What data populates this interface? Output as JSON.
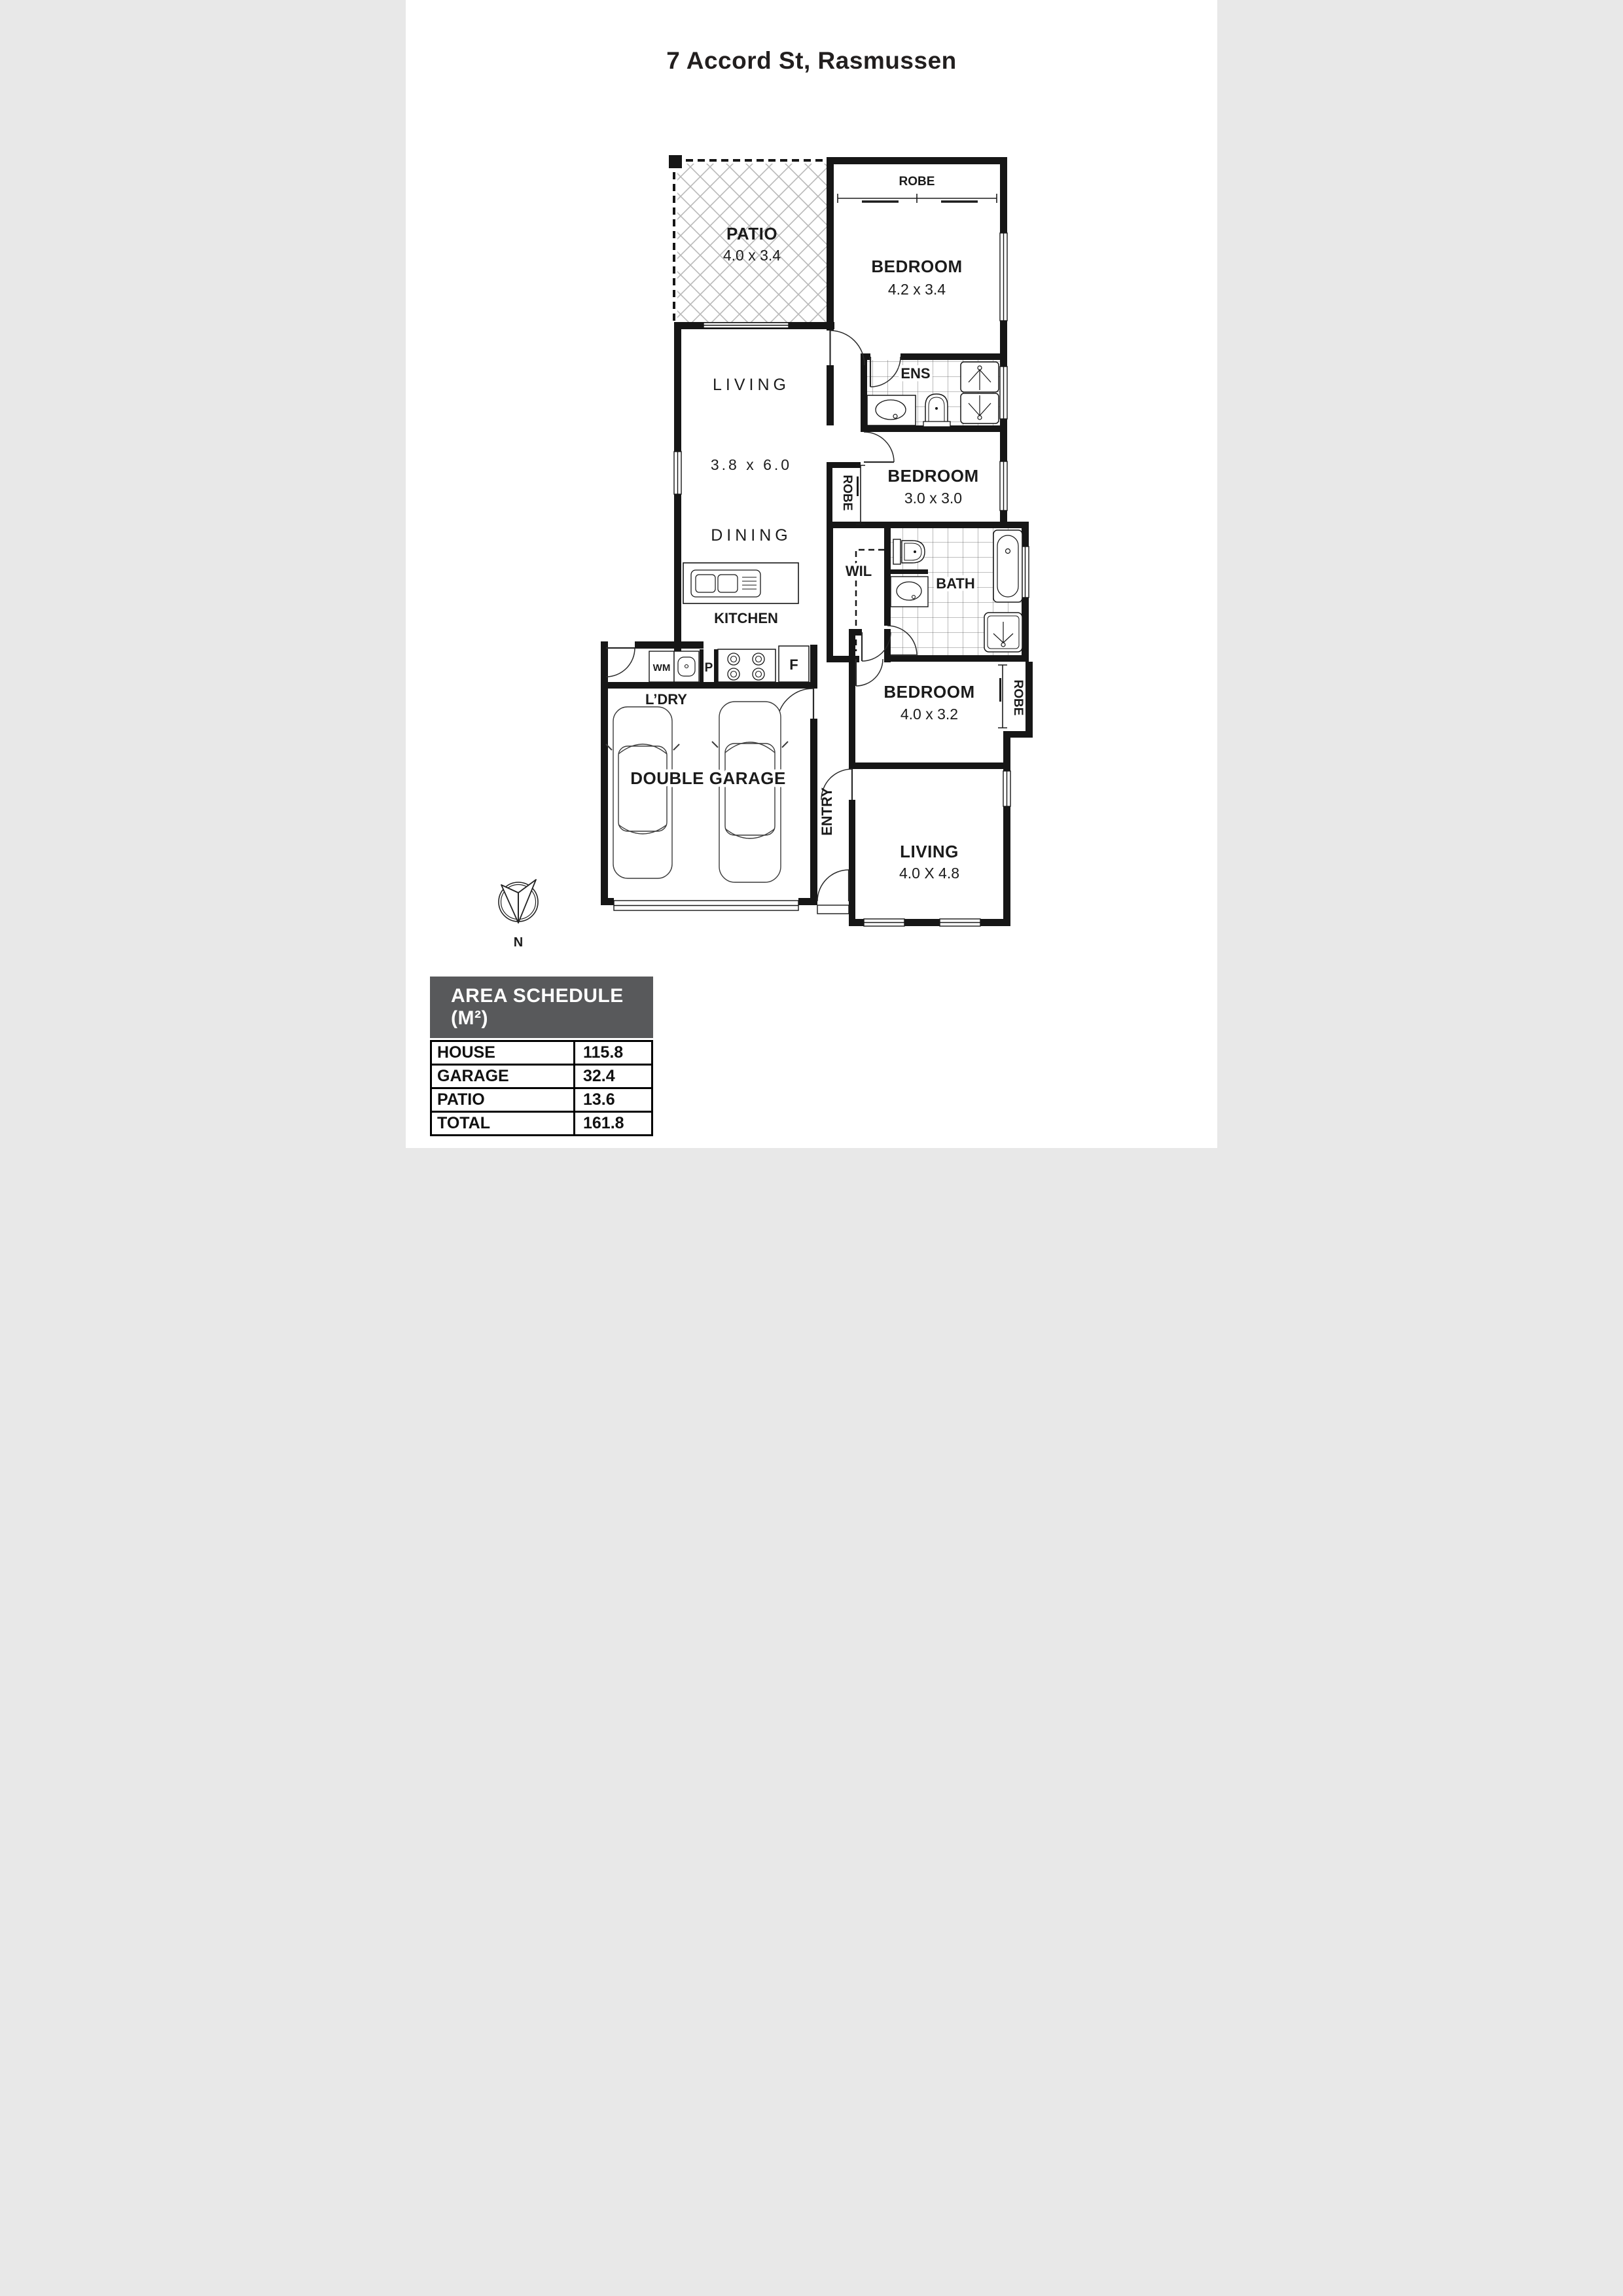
{
  "title": "7 Accord St, Rasmussen",
  "plan": {
    "rooms": {
      "patio": {
        "name": "PATIO",
        "dims": "4.0 x 3.4"
      },
      "bedroom1": {
        "name": "BEDROOM",
        "dims": "4.2 x 3.4"
      },
      "living_main": {
        "name": "LIVING",
        "dims": "3.8 x 6.0"
      },
      "dining": {
        "name": "DINING"
      },
      "ens": {
        "name": "ENS"
      },
      "bedroom2": {
        "name": "BEDROOM",
        "dims": "3.0 x 3.0"
      },
      "wil": {
        "name": "WIL"
      },
      "bath": {
        "name": "BATH"
      },
      "kitchen": {
        "name": "KITCHEN"
      },
      "laundry": {
        "name": "L’DRY"
      },
      "garage": {
        "name": "DOUBLE GARAGE"
      },
      "bedroom3": {
        "name": "BEDROOM",
        "dims": "4.0 x 3.2"
      },
      "living_rear": {
        "name": "LIVING",
        "dims": "4.0 X 4.8"
      },
      "entry": {
        "name": "ENTRY"
      }
    },
    "labels": {
      "robe1": "ROBE",
      "robe2": "ROBE",
      "robe3": "ROBE",
      "wm": "WM",
      "pantry": "P",
      "fridge": "F"
    },
    "compass": {
      "north": "N"
    },
    "colors": {
      "wall": "#161616",
      "hatch": "#b9b9b9",
      "tile_line": "#555555",
      "schedule_header_bg": "#58595b"
    }
  },
  "area_schedule": {
    "header": "AREA SCHEDULE (M²)",
    "rows": [
      {
        "label": "HOUSE",
        "value": "115.8"
      },
      {
        "label": "GARAGE",
        "value": "32.4"
      },
      {
        "label": "PATIO",
        "value": "13.6"
      },
      {
        "label": "TOTAL",
        "value": "161.8"
      }
    ]
  }
}
